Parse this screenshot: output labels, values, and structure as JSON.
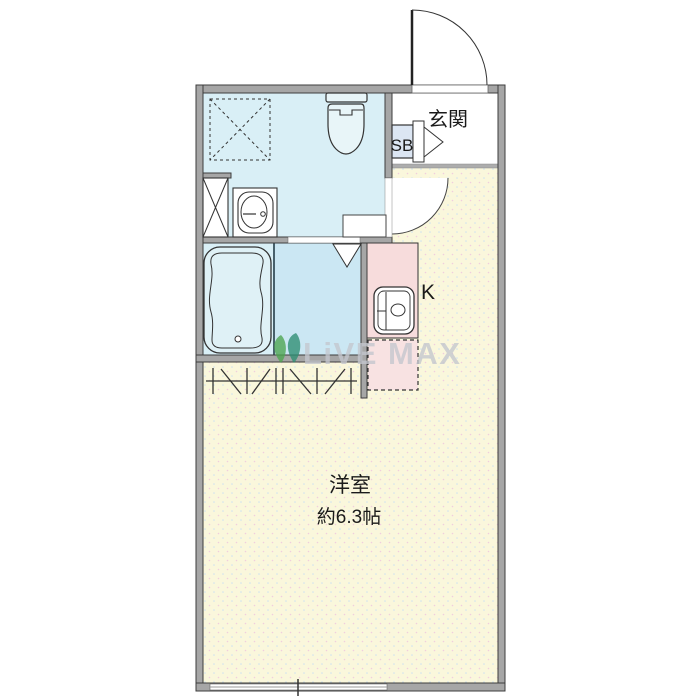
{
  "plan": {
    "labels": {
      "entrance": "玄関",
      "shoe_box": "SB",
      "kitchen": "K",
      "main_room": "洋室",
      "main_room_size": "約6.3帖"
    },
    "watermark": {
      "brand": "LiVE MAX"
    },
    "colors": {
      "wall": "#a6a6a6",
      "washroom_floor": "#d9eff6",
      "shower_floor": "#cbe7f3",
      "main_room_floor": "#faf7dc",
      "kitchen_counter": "#f7dcdc",
      "refrigerator_space": "#f8e2e2",
      "shoe_box_fill": "#dce6f3",
      "entrance_floor": "#ffffff",
      "watermark_text": "#c4c7ce",
      "watermark_leaf_green": "#4da550",
      "watermark_leaf_teal": "#2e8e72"
    },
    "fixtures": [
      "entry-door-swing",
      "shoe-box",
      "toilet",
      "washbasin",
      "washing-machine-pan",
      "shower-area",
      "bathtub",
      "kitchen-sink",
      "refrigerator-space-dashed",
      "hanger-pipe",
      "sliding-window",
      "room-door-swing"
    ]
  }
}
